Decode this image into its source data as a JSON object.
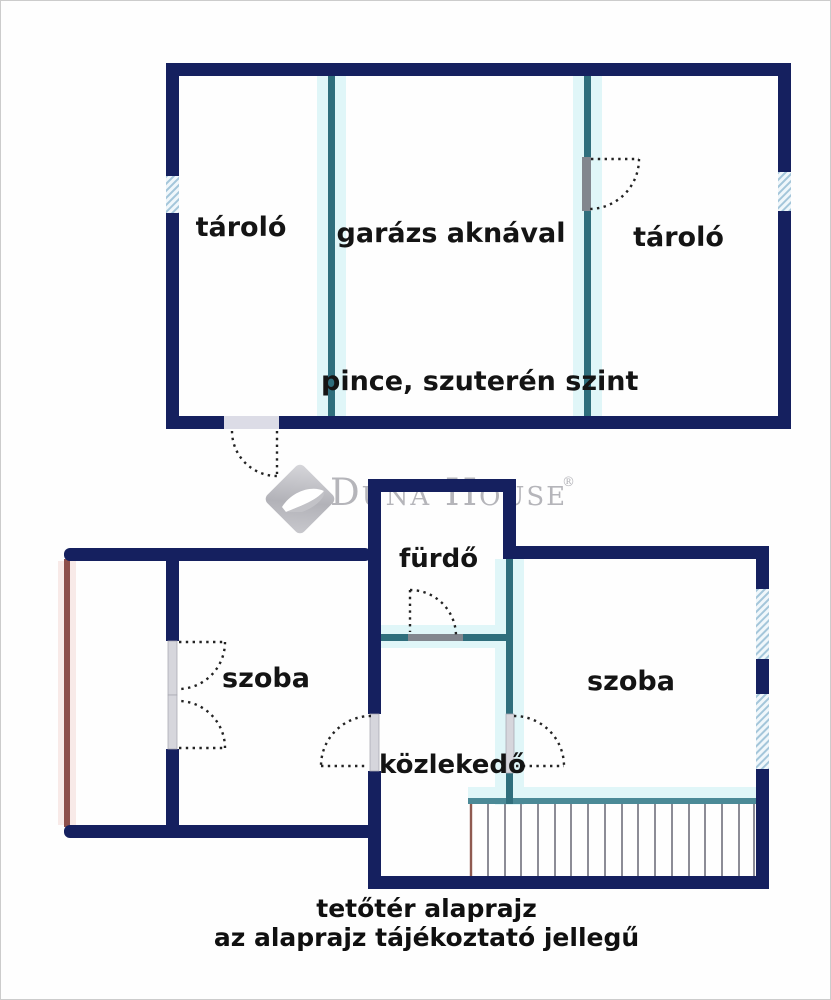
{
  "watermark": {
    "brand": "Duna House",
    "registered_mark": "®"
  },
  "upper_plan": {
    "level_label": "pince, szuterén szint",
    "room_left": "tároló",
    "room_middle": "garázs aknával",
    "room_right": "tároló"
  },
  "lower_plan": {
    "room_left": "szoba",
    "room_bath": "fürdő",
    "room_hall": "közlekedő",
    "room_right": "szoba"
  },
  "caption": {
    "line1": "tetőtér alaprajz",
    "line2": "az alaprajz tájékoztató jellegű"
  },
  "colors": {
    "wall_navy": "#15205f",
    "partition_teal": "#2f6e7c",
    "partition_glow": "#e0f6f8",
    "stair_rail_teal": "#4b8a97",
    "terrace_edge_red": "#8d4f4b",
    "window_hatch_blue": "#a4c6da",
    "door_leaf_gray": "#d6d6dc",
    "door_swing_dotted": "#232323",
    "stair_tread_gray": "#8c8c96",
    "label_text": "#141414",
    "watermark_gray": "#b5b5ba"
  }
}
